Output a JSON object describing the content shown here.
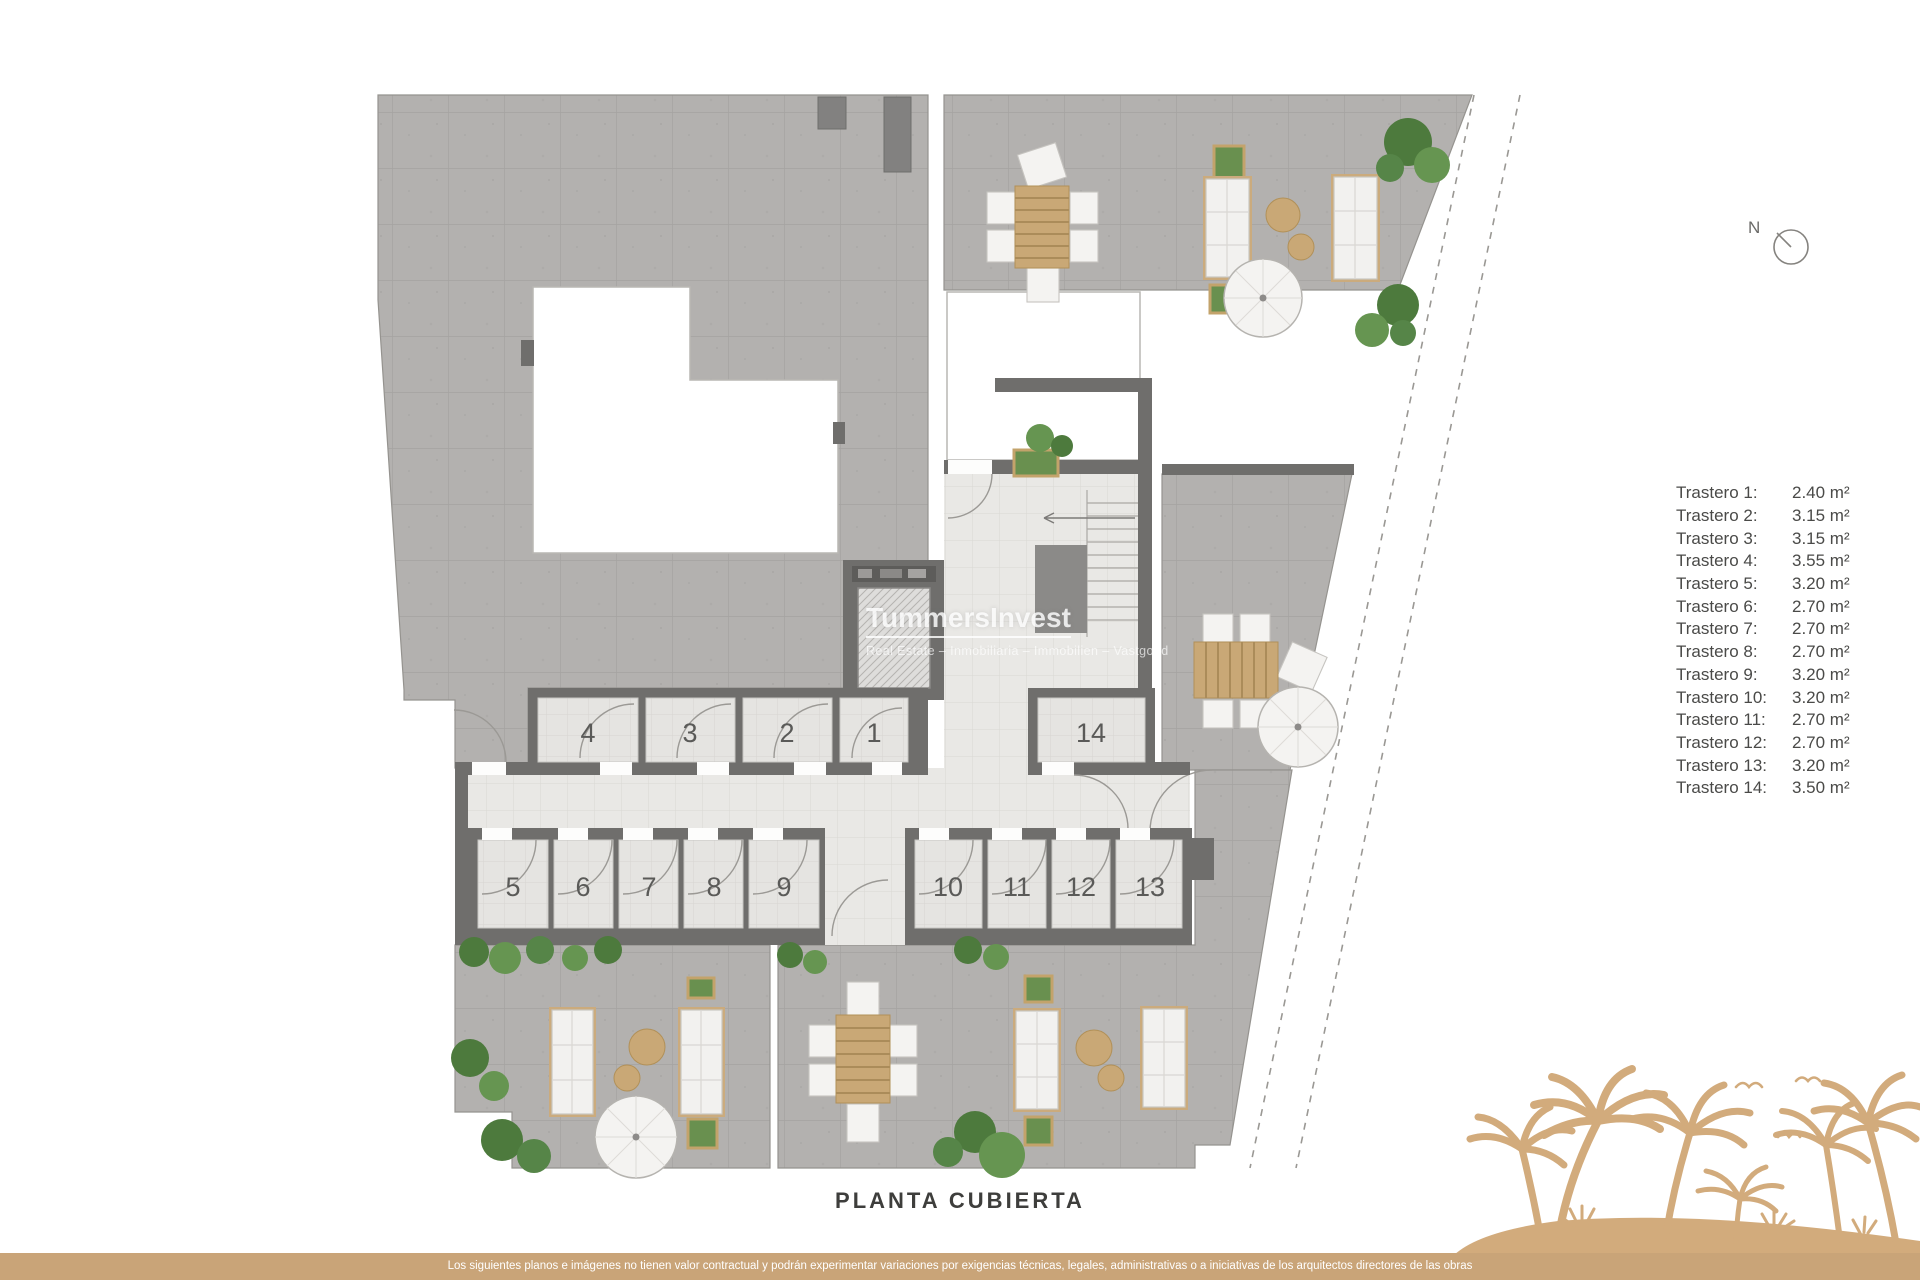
{
  "title": "PLANTA CUBIERTA",
  "compass": {
    "label": "N"
  },
  "watermark": {
    "name": "TummersInvest",
    "tagline": "Real Estate – Inmobiliaria – Immobilien – Vastgoed"
  },
  "legend": {
    "items": [
      {
        "label": "Trastero 1:",
        "value": "2.40 m²"
      },
      {
        "label": "Trastero 2:",
        "value": "3.15 m²"
      },
      {
        "label": "Trastero 3:",
        "value": "3.15 m²"
      },
      {
        "label": "Trastero 4:",
        "value": "3.55 m²"
      },
      {
        "label": "Trastero 5:",
        "value": "3.20 m²"
      },
      {
        "label": "Trastero 6:",
        "value": "2.70 m²"
      },
      {
        "label": "Trastero 7:",
        "value": "2.70 m²"
      },
      {
        "label": "Trastero 8:",
        "value": "2.70 m²"
      },
      {
        "label": "Trastero 9:",
        "value": "3.20 m²"
      },
      {
        "label": "Trastero 10:",
        "value": "3.20 m²"
      },
      {
        "label": "Trastero 11:",
        "value": "2.70 m²"
      },
      {
        "label": "Trastero 12:",
        "value": "2.70 m²"
      },
      {
        "label": "Trastero 13:",
        "value": "3.20 m²"
      },
      {
        "label": "Trastero 14:",
        "value": "3.50 m²"
      }
    ]
  },
  "plan": {
    "rooms": [
      {
        "number": "1"
      },
      {
        "number": "2"
      },
      {
        "number": "3"
      },
      {
        "number": "4"
      },
      {
        "number": "5"
      },
      {
        "number": "6"
      },
      {
        "number": "7"
      },
      {
        "number": "8"
      },
      {
        "number": "9"
      },
      {
        "number": "10"
      },
      {
        "number": "11"
      },
      {
        "number": "12"
      },
      {
        "number": "13"
      },
      {
        "number": "14"
      }
    ]
  },
  "footer": {
    "disclaimer": "Los siguientes planos e imágenes no tienen valor contractual y podrán experimentar variaciones por exigencias técnicas, legales, administrativas o a iniciativas de los arquitectos directores de las obras"
  },
  "colors": {
    "accent_tan": "#c9a478",
    "palm_tan": "#d2ab7c",
    "wall_gray": "#6f6e6c",
    "terrace_gray": "#b3b1af",
    "plant_green": "#56813f"
  }
}
